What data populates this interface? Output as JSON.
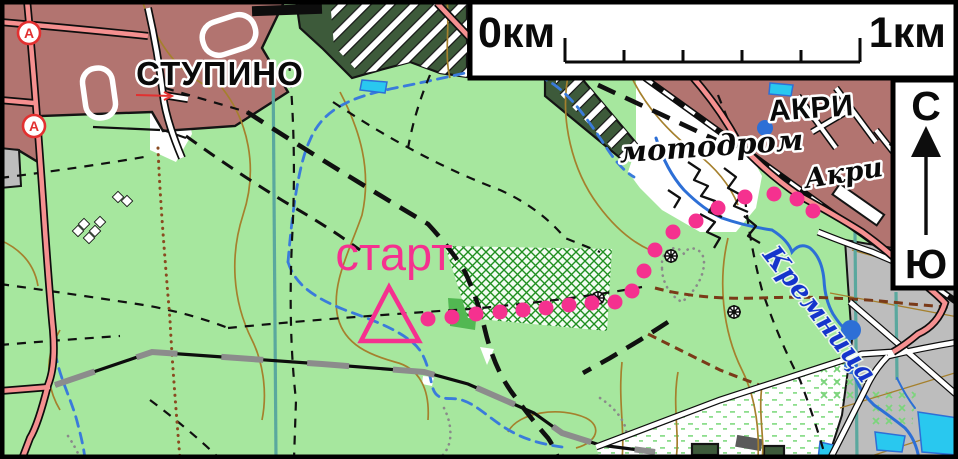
{
  "map": {
    "labels": {
      "city_top_left": "СТУПИНО",
      "city_top_right": "АКРИ",
      "motodrom": "мотодром",
      "station": "Акри",
      "river": "Кремница",
      "start": "старт"
    },
    "scale_bar": {
      "start": "0км",
      "end": "1км"
    },
    "compass": {
      "north": "С",
      "south": "Ю"
    },
    "symbols": {
      "bus_stop": "А"
    },
    "route": {
      "dots": [
        [
          428,
          319
        ],
        [
          452,
          317
        ],
        [
          476,
          314
        ],
        [
          500,
          312
        ],
        [
          523,
          310
        ],
        [
          546,
          308
        ],
        [
          569,
          305
        ],
        [
          592,
          303
        ],
        [
          615,
          302
        ],
        [
          632,
          291
        ],
        [
          644,
          271
        ],
        [
          655,
          250
        ],
        [
          673,
          232
        ],
        [
          696,
          221
        ],
        [
          718,
          208
        ],
        [
          745,
          197
        ],
        [
          774,
          194
        ],
        [
          797,
          199
        ],
        [
          813,
          211
        ]
      ],
      "start_triangle": [
        [
          389,
          287
        ],
        [
          361,
          341
        ],
        [
          419,
          341
        ]
      ]
    },
    "colors": {
      "forest": "#a6e79e",
      "urban": "#b27470",
      "road_pink": "#f59090",
      "gray": "#bdbdbd",
      "dark_green": "#3d5a3a",
      "mid_green": "#52b852",
      "lattice_green": "#1f8f1f",
      "marsh_green": "#7cd47c",
      "water_fill": "#29c8ef",
      "water_line": "#2d6fd6",
      "stream": "#3a7bdb",
      "contour": "#a5802d",
      "route": "#f5318f",
      "teal": "#5aa89e",
      "label_blue": "#1535cc",
      "bus_red": "#e23030",
      "power_gray": "#8c8c8c",
      "brown_trail": "#7a3a18",
      "dot_brown": "#8a4a20",
      "gray_dots": "#8a8a8a"
    }
  }
}
